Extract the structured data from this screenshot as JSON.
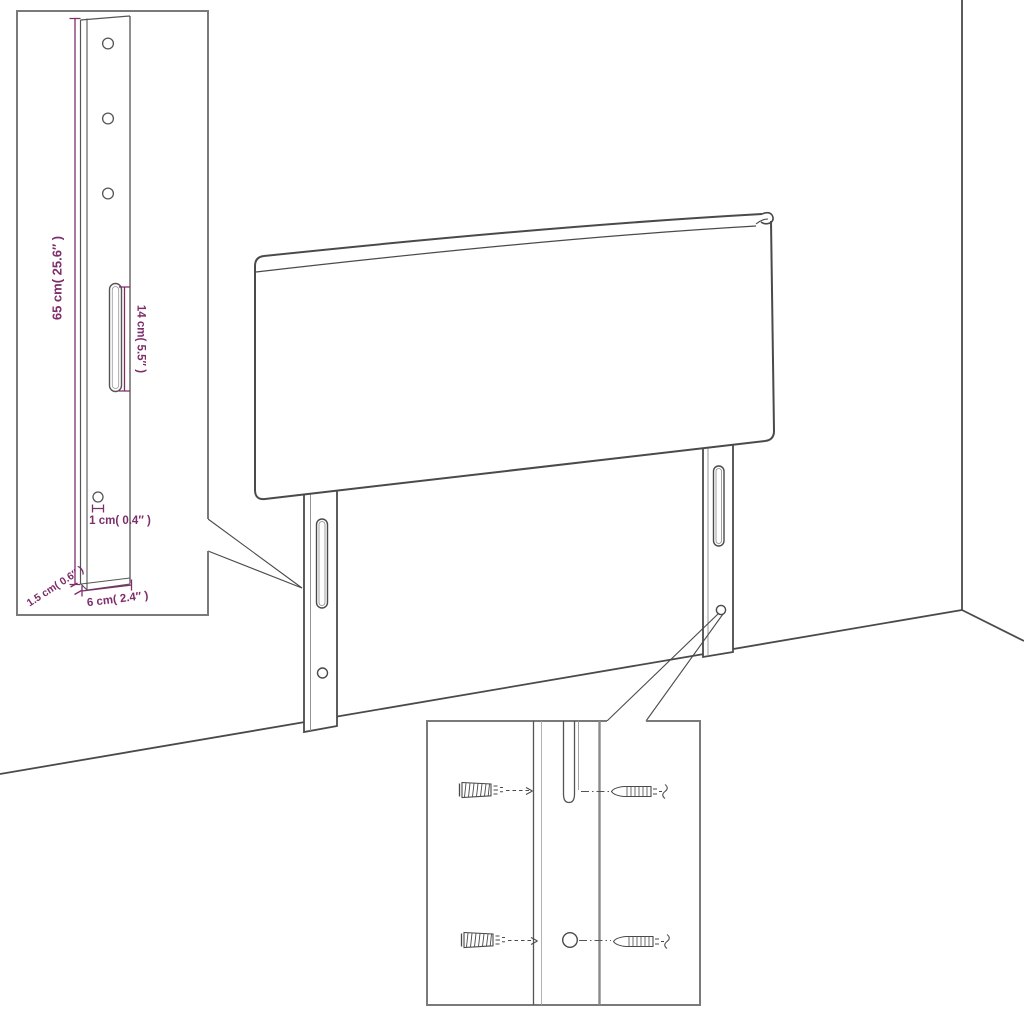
{
  "diagram": {
    "kind": "headboard wall-mount assembly dimension diagram",
    "colors": {
      "dimension_text": "#7E2D6B",
      "drawing_line": "#4A4A4A",
      "inset_border": "#7A7A7A",
      "background": "#FFFFFF"
    }
  },
  "labels": {
    "bracket_height": "65 cm( 25.6″ )",
    "slot_length": "14 cm( 5.5″ )",
    "hole_diameter": "1 cm( 0.4″ )",
    "bracket_thickness": "1.5 cm( 0.6″ )",
    "bracket_width": "6 cm( 2.4″ )"
  }
}
